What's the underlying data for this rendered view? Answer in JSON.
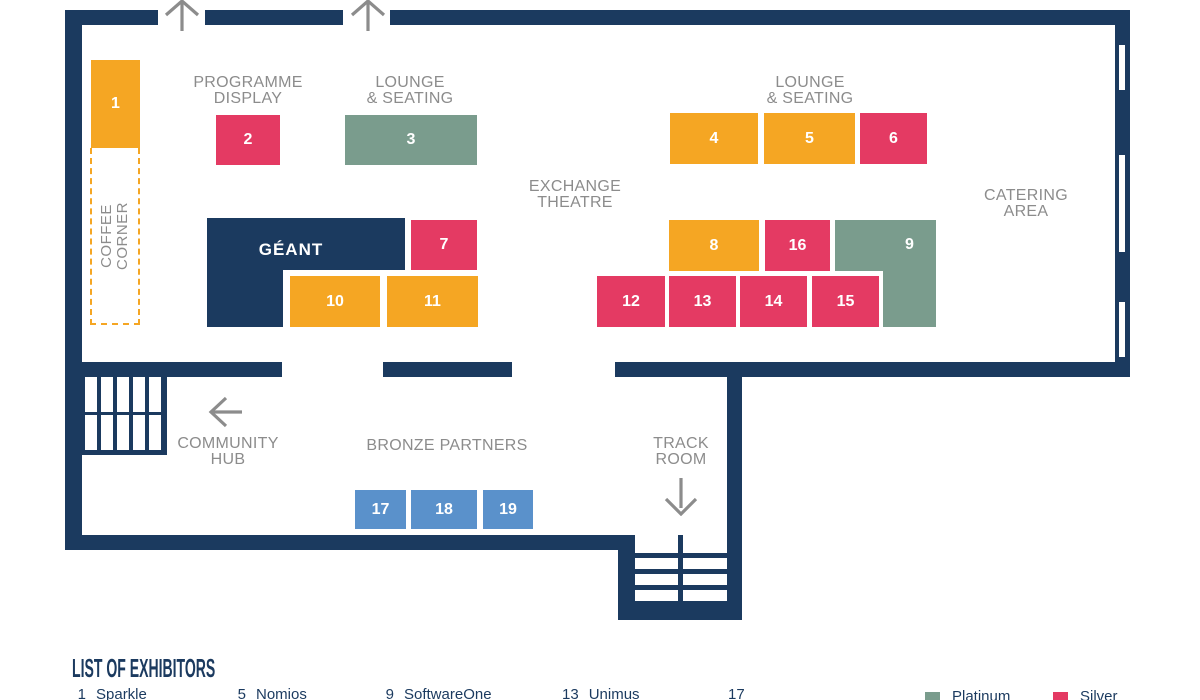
{
  "palette": {
    "navy": "#1B3A5F",
    "orange": "#F5A623",
    "pink": "#E43A63",
    "green": "#7A9C8D",
    "blue": "#5A91CB",
    "label_gray": "#8C8C8C",
    "background": "#FFFFFF"
  },
  "labels": {
    "coffee_l1": "COFFEE",
    "coffee_l2": "CORNER",
    "programme_l1": "PROGRAMME",
    "programme_l2": "DISPLAY",
    "lounge_l1": "LOUNGE",
    "lounge_l2": "& SEATING",
    "exchange_l1": "EXCHANGE",
    "exchange_l2": "THEATRE",
    "catering_l1": "CATERING",
    "catering_l2": "AREA",
    "community_l1": "COMMUNITY",
    "community_l2": "HUB",
    "bronze": "BRONZE PARTNERS",
    "track_l1": "TRACK",
    "track_l2": "ROOM",
    "geant": "GÉANT"
  },
  "booths": [
    {
      "n": "1",
      "color": "orange",
      "x": 91,
      "y": 60,
      "w": 49,
      "h": 88
    },
    {
      "n": "2",
      "color": "pink",
      "x": 216,
      "y": 115,
      "w": 64,
      "h": 50
    },
    {
      "n": "3",
      "color": "green",
      "x": 345,
      "y": 115,
      "w": 132,
      "h": 50
    },
    {
      "n": "4",
      "color": "orange",
      "x": 670,
      "y": 113,
      "w": 88,
      "h": 51
    },
    {
      "n": "5",
      "color": "orange",
      "x": 764,
      "y": 113,
      "w": 91,
      "h": 51
    },
    {
      "n": "6",
      "color": "pink",
      "x": 860,
      "y": 113,
      "w": 67,
      "h": 51
    },
    {
      "n": "7",
      "color": "pink",
      "x": 411,
      "y": 220,
      "w": 66,
      "h": 50
    },
    {
      "n": "8",
      "color": "orange",
      "x": 669,
      "y": 220,
      "w": 90,
      "h": 51
    },
    {
      "n": "9",
      "color": "green",
      "x": 883,
      "y": 220,
      "w": 53,
      "h": 107,
      "num_at_top": true,
      "ext": {
        "x": 835,
        "y": 220,
        "w": 48,
        "h": 51
      }
    },
    {
      "n": "10",
      "color": "orange",
      "x": 290,
      "y": 276,
      "w": 90,
      "h": 51
    },
    {
      "n": "11",
      "color": "orange",
      "x": 387,
      "y": 276,
      "w": 91,
      "h": 51
    },
    {
      "n": "12",
      "color": "pink",
      "x": 597,
      "y": 276,
      "w": 68,
      "h": 51
    },
    {
      "n": "13",
      "color": "pink",
      "x": 669,
      "y": 276,
      "w": 67,
      "h": 51
    },
    {
      "n": "14",
      "color": "pink",
      "x": 740,
      "y": 276,
      "w": 67,
      "h": 51
    },
    {
      "n": "15",
      "color": "pink",
      "x": 812,
      "y": 276,
      "w": 67,
      "h": 51
    },
    {
      "n": "16",
      "color": "pink",
      "x": 765,
      "y": 220,
      "w": 65,
      "h": 51
    },
    {
      "n": "17",
      "color": "blue",
      "x": 355,
      "y": 490,
      "w": 51,
      "h": 39
    },
    {
      "n": "18",
      "color": "blue",
      "x": 411,
      "y": 490,
      "w": 66,
      "h": 39
    },
    {
      "n": "19",
      "color": "blue",
      "x": 483,
      "y": 490,
      "w": 50,
      "h": 39
    }
  ],
  "exhibitor_list": {
    "title": "LIST OF EXHIBITORS",
    "items": [
      {
        "num": "1",
        "name": "Sparkle",
        "x": 72
      },
      {
        "num": "5",
        "name": "Nomios",
        "x": 232
      },
      {
        "num": "9",
        "name": "SoftwareOne",
        "x": 380
      },
      {
        "num": "13",
        "name": "Unimus",
        "x": 562
      },
      {
        "num": "17",
        "name": "",
        "x": 728
      }
    ]
  },
  "legend": [
    {
      "label": "Platinum",
      "color": "green",
      "x": 925
    },
    {
      "label": "Silver",
      "color": "pink",
      "x": 1053
    }
  ]
}
